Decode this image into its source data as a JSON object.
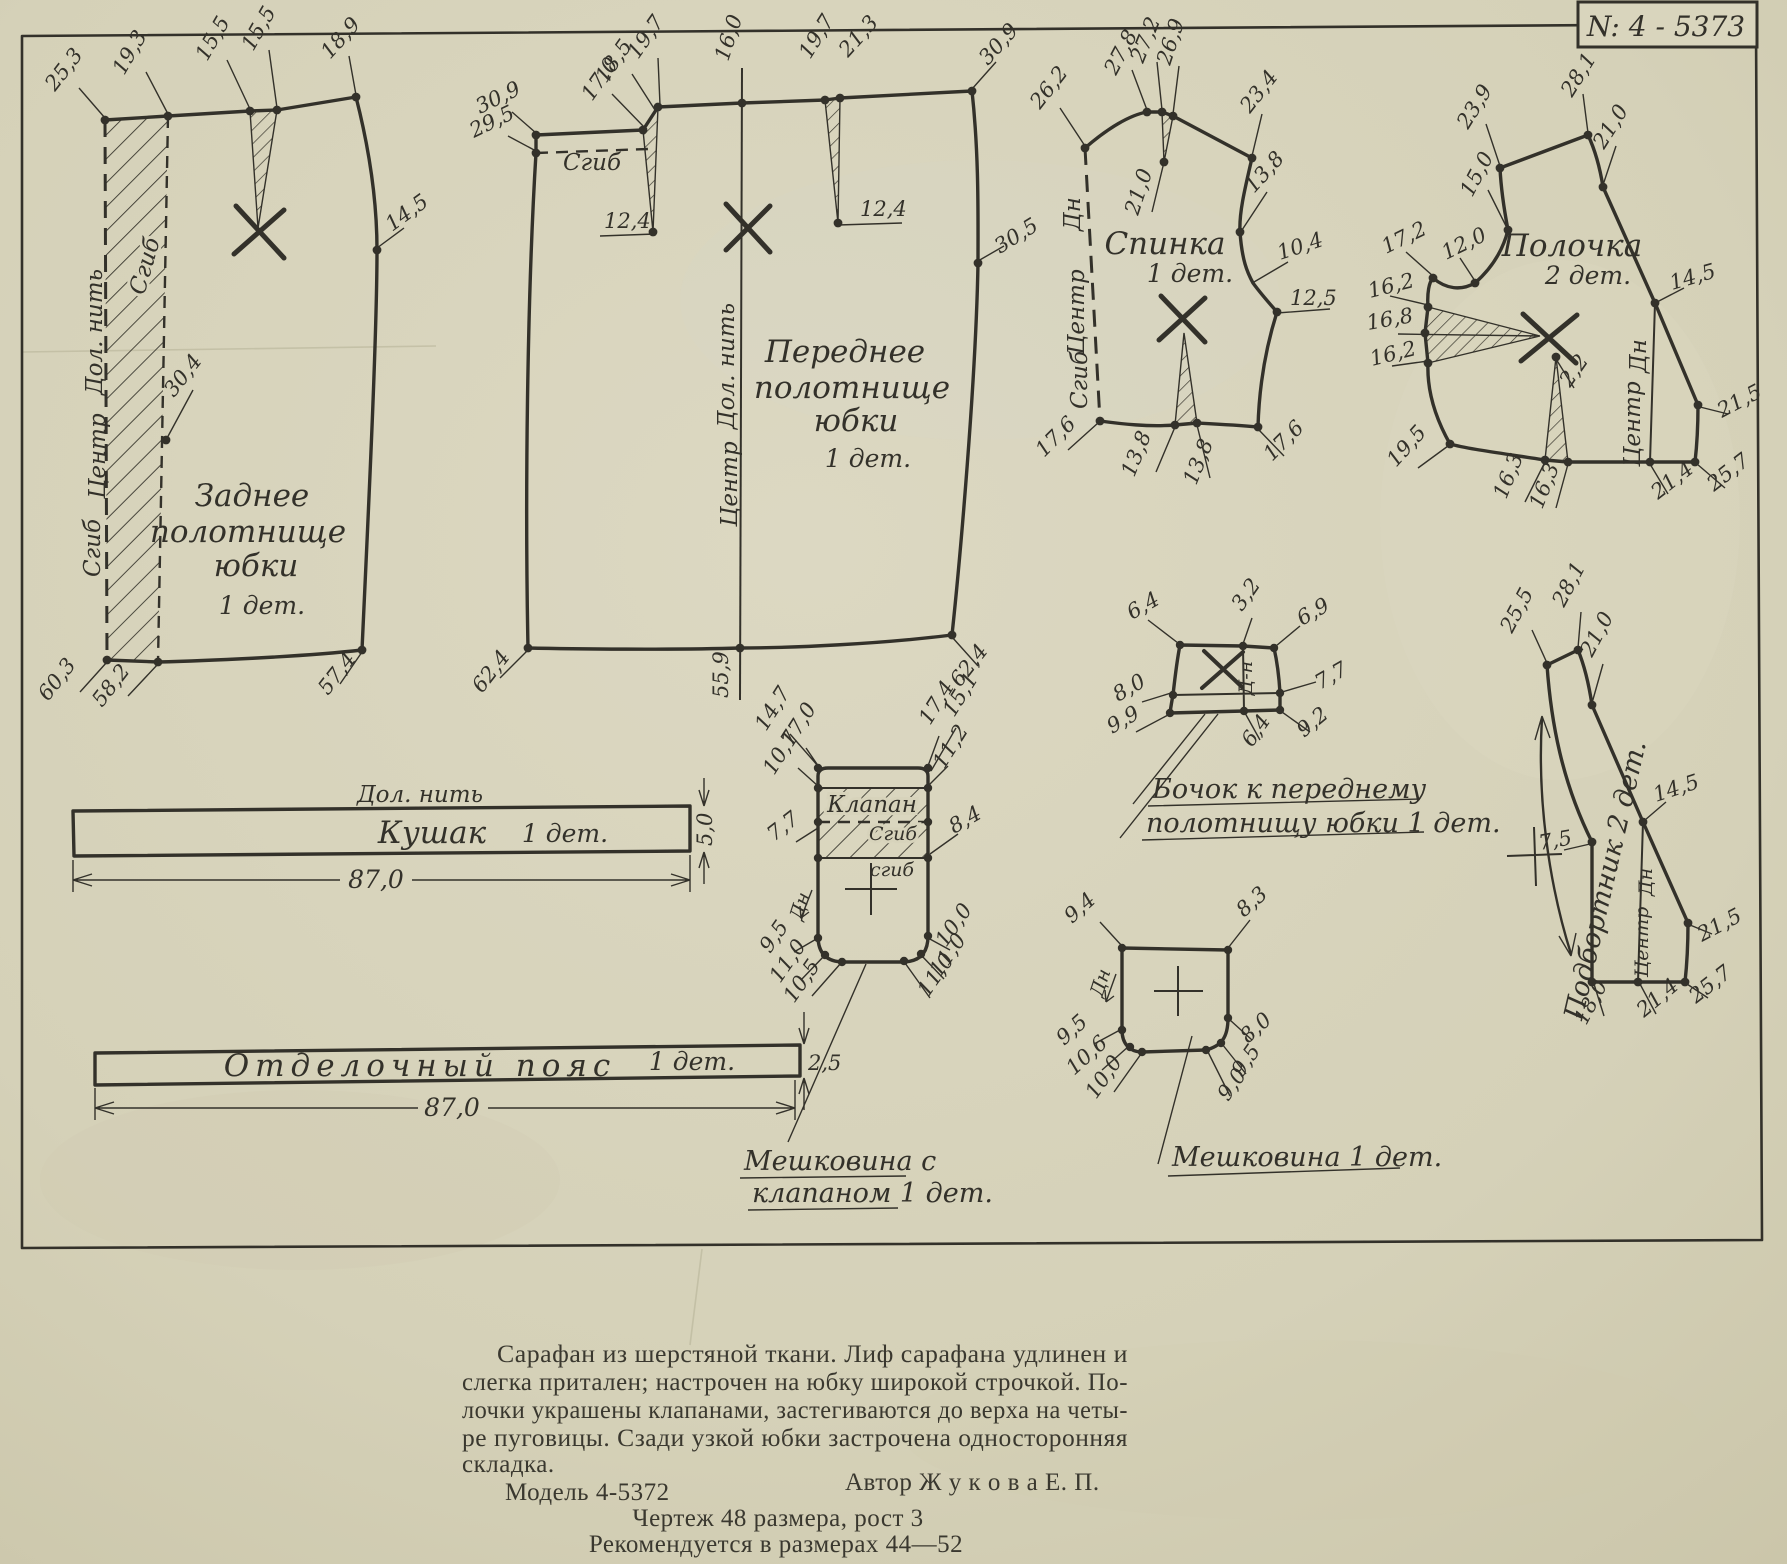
{
  "page": {
    "stamp_number": "N: 4 - 5373"
  },
  "colors": {
    "paper": "#d7d3bb",
    "ink": "#33312a"
  },
  "pieces": {
    "back_skirt": {
      "title_lines": [
        "Заднее",
        "полотнище",
        "юбки"
      ],
      "count": "1 дет.",
      "fold_left": "Сгиб",
      "grain": "Дол. нить",
      "center": "Центр",
      "fold_inner": "Сгиб",
      "m": {
        "top1": "25,3",
        "top2": "19,3",
        "top3": "15,5",
        "top4": "15,5",
        "top5": "18,9",
        "side": "14,5",
        "pleat": "30,4",
        "bottom1": "60,3",
        "bottom2": "58,2",
        "bottom3": "57,4"
      }
    },
    "front_skirt": {
      "title_lines": [
        "Переднее",
        "полотнище",
        "юбки"
      ],
      "count": "1 дет.",
      "fold": "Сгиб",
      "grain": "Дол. нить",
      "center": "Центр",
      "m": {
        "left1": "30,9",
        "left2": "29,5",
        "dart1a": "17,0",
        "dart1b": "18,5",
        "dart1c": "19,7",
        "dart1_len": "12,4",
        "center_top": "16,0",
        "dart2a": "19,7",
        "dart2b": "21,3",
        "dart2_len": "12,4",
        "right_top": "30,9",
        "side": "30,5",
        "bottom1": "62,4",
        "bottom2": "55,9",
        "bottom3": "62,4"
      }
    },
    "spinka": {
      "title": "Спинка",
      "count": "1 дет.",
      "grain": "Дн",
      "center": "Центр",
      "fold": "Сгиб",
      "m": {
        "neck": "26,2",
        "sh1": "27,8",
        "sh2": "27,2",
        "sh3": "26,9",
        "dart_len": "21,0",
        "shoulder": "23,4",
        "arm1": "13,8",
        "arm2": "10,4",
        "side1": "12,5",
        "side2": "17,6",
        "waist1": "13,8",
        "waist2": "13,8",
        "bottom": "17,6"
      }
    },
    "polochka": {
      "title": "Полочка",
      "count": "2 дет.",
      "center": "Центр",
      "grain": "Дн",
      "m": {
        "top1": "23,9",
        "top2": "28,1",
        "right1": "21,0",
        "left1": "15,0",
        "left2": "17,2",
        "left3": "12,0",
        "bust1": "16,2",
        "bust2": "16,8",
        "bust3": "16,2",
        "apex": "2,2",
        "bottom_left": "19,5",
        "waist1": "16,3",
        "waist2": "16,3",
        "right2": "14,5",
        "right3": "21,5",
        "right4": "25,7",
        "bottom": "21,4"
      }
    },
    "kushak": {
      "grain": "Дол. нить",
      "name": "Кушак",
      "count": "1 дет.",
      "length": "87,0",
      "width": "5,0"
    },
    "poyas": {
      "name": "Отделочный  пояс",
      "count": "1 дет.",
      "length": "87,0",
      "width": "2,5"
    },
    "meshkovina_klapan": {
      "flap": "Клапан",
      "fold1": "Сгиб",
      "fold2": "сгиб",
      "grain": "Дн",
      "m": {
        "top1": "14,7",
        "top2": "17,0",
        "top3": "17,4",
        "top4": "15,1",
        "left1": "10,7",
        "right1": "11,2",
        "left2": "7,7",
        "right2": "8,4",
        "bl1": "9,5",
        "bl2": "11,0",
        "bl3": "10,5",
        "br1": "10,0",
        "br2": "11,0",
        "br3": "11,0"
      },
      "caption_lines": [
        "Мешковина с",
        "клапаном  1 дет."
      ]
    },
    "bochok": {
      "grain": "Д-н",
      "m": {
        "top1": "6,4",
        "top2": "3,2",
        "top3": "6,9",
        "left1": "8,0",
        "left2": "9,9",
        "right1": "7,7",
        "right2": "9,2",
        "bottom": "6,4"
      },
      "caption_lines": [
        "Бочок к переднему",
        "полотнищу юбки  1 дет."
      ]
    },
    "meshkovina": {
      "grain": "Дн",
      "m": {
        "top1": "9,4",
        "top2": "8,3",
        "bl1": "9,5",
        "bl2": "10,6",
        "bl3": "10,0",
        "br1": "8,0",
        "br2": "9,5",
        "br3": "9,0"
      },
      "caption": "Мешковина   1 дет."
    },
    "podbortnik": {
      "name": "Подбортник 2 дет.",
      "center": "Центр",
      "grain": "Дн",
      "m": {
        "top1": "25,5",
        "top2": "28,1",
        "right1": "21,0",
        "right2": "14,5",
        "left": "7,5",
        "right3": "21,5",
        "right4": "25,7",
        "bottom1": "18,0",
        "bottom2": "21,4"
      }
    }
  },
  "footer": {
    "paragraph_lines": [
      "Сарафан из шерстяной ткани.  Лиф  сарафана   удлинен и",
      "слегка притален; настрочен на юбку широкой строчкой. По-",
      "лочки украшены клапанами, застегиваются до верха на четы-",
      "ре пуговицы.   Сзади узкой юбки застрочена односторонняя",
      "складка."
    ],
    "model": "Модель 4-5372",
    "author": "Автор  Ж у к о в а   Е. П.",
    "note1": "Чертеж 48 размера, рост 3",
    "note2": "Рекомендуется в размерах 44—52"
  }
}
